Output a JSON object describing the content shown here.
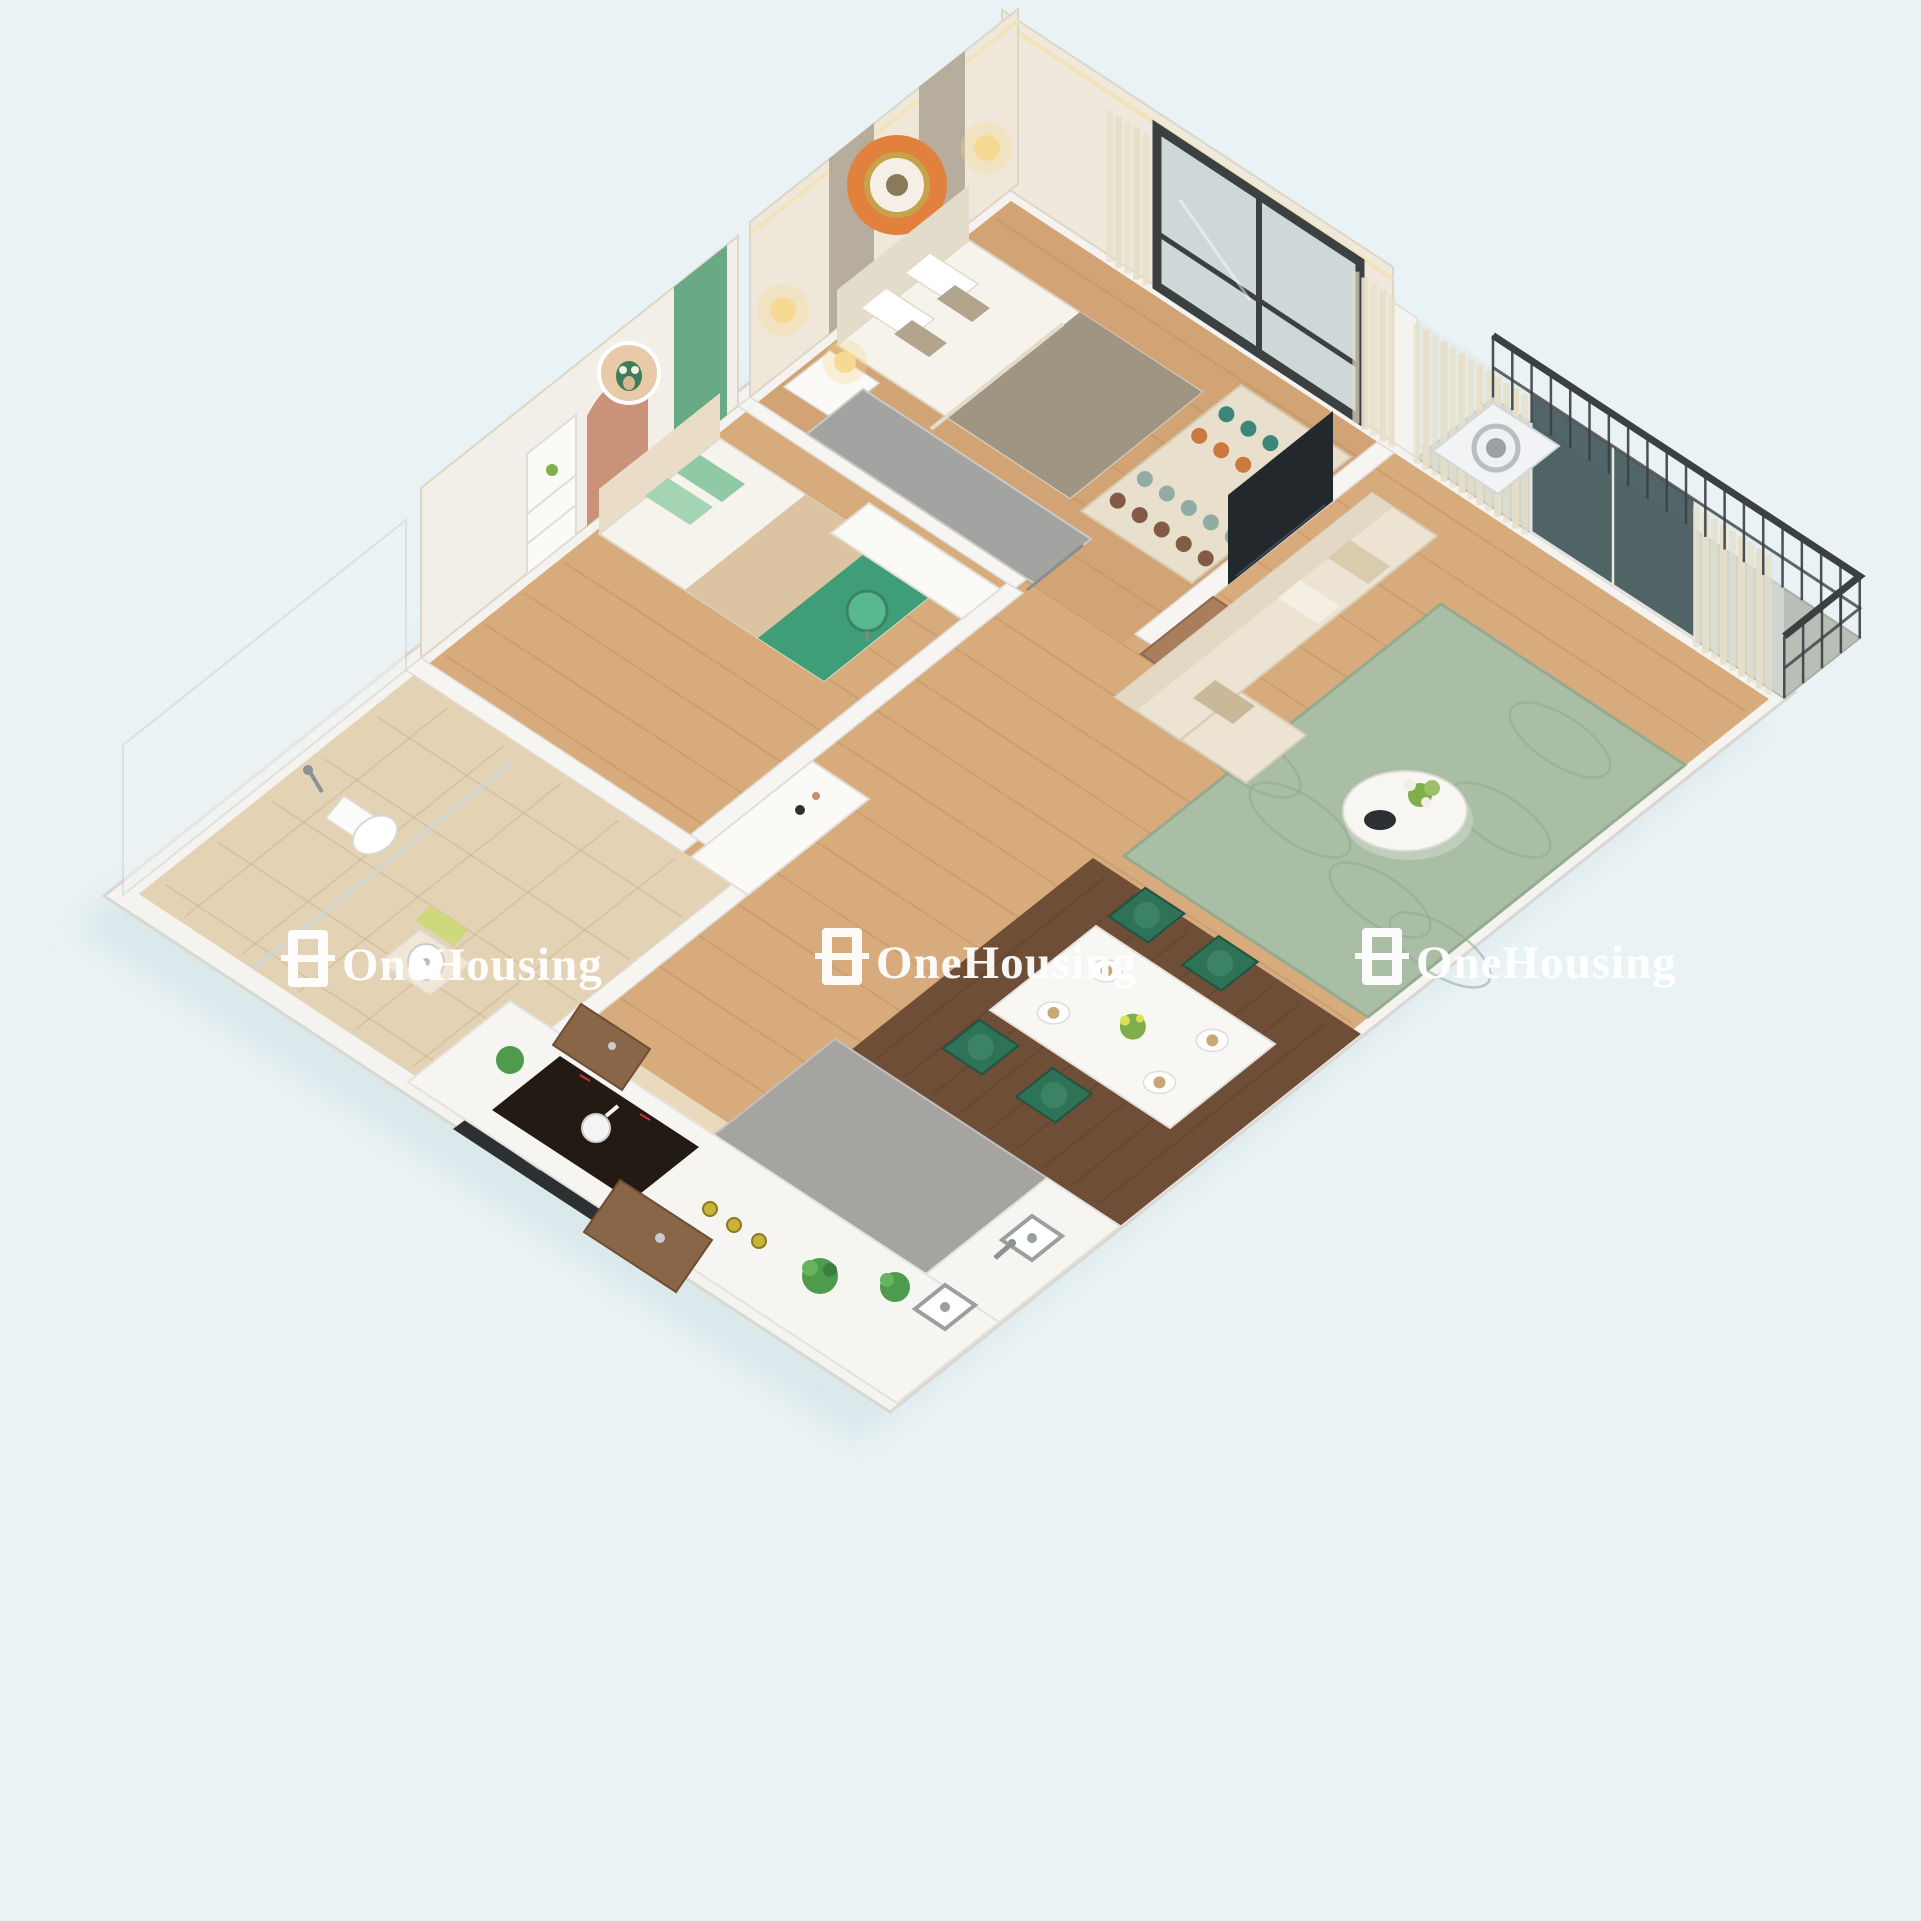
{
  "scene": {
    "description": "3D isometric cutaway render of a two-bedroom apartment floor plan",
    "background_color": "#e9f3f5"
  },
  "watermark": {
    "label": "OneHousing",
    "logo_icon": "onehousing-logo",
    "color": "#ffffff",
    "instances": 3
  },
  "palette": {
    "wall_white": "#f4f3ef",
    "wall_face_cream": "#efe8da",
    "wood_floor": "#d2a475",
    "wood_plank_line": "#b9895c",
    "dark_wood_dining": "#6f4e38",
    "dark_wood_line": "#5d4130",
    "bathroom_tile": "#e4d2b4",
    "tile_line": "#c9b28e",
    "entry_tile": "#ead9bd",
    "sage_rug": "#a9bfa8",
    "sage_line": "#8fa78f",
    "hex_rug_base": "#e8dfcc",
    "hex_colors": [
      "#2f7d74",
      "#c96f33",
      "#e8dfcc",
      "#8aa7a0",
      "#7a4f3a"
    ],
    "accent_green_wall": "#69a986",
    "accent_orange_circle": "#e2813d",
    "accent_pink_arch": "#c78c72",
    "kids_green_throw": "#3f9e77",
    "kids_pillow_green": "#8fc9a5",
    "dining_chair_green": "#2e7257",
    "dining_chair_seat": "#3c8366",
    "sofa_cream": "#ece3d2",
    "gray_desk": "#a3a3a1",
    "gray_counter": "#a6a4a1",
    "cooktop_black": "#241a14",
    "marble_dark": "#2d3033",
    "door_wood": "#8a6648",
    "railing_dark": "#3c4043",
    "glass_teal": "#3f5457",
    "curtain_cream": "#e8dfc8",
    "lamp_warm": "#f6d992",
    "bed_blanket_taupe": "#a09483",
    "plant_green": "#4e9b4e",
    "bottle_yellow": "#c9b23a"
  }
}
